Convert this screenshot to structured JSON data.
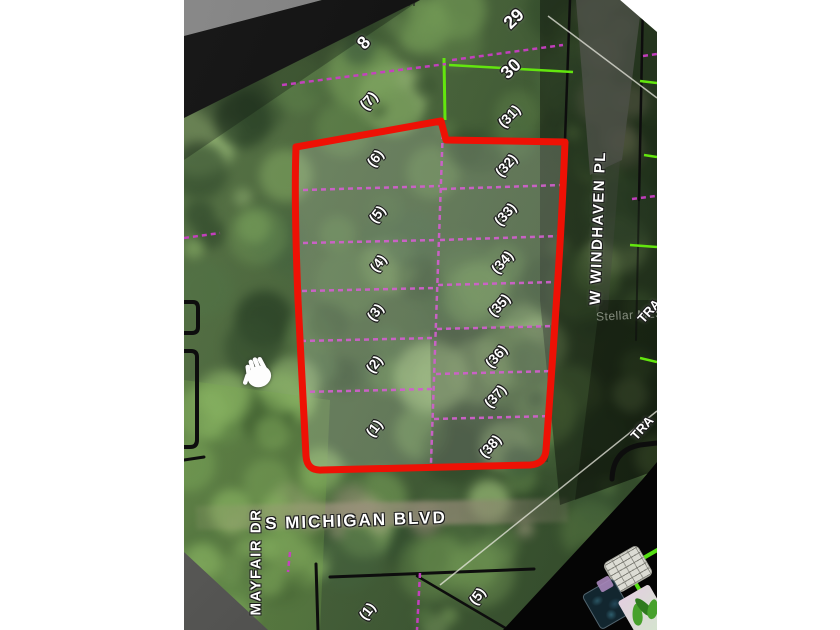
{
  "photo": {
    "watermark": "Stellar MLS",
    "streets": {
      "michigan": "S MICHIGAN BLVD",
      "mayfair": "MAYFAIR DR",
      "windhaven": "W WINDHAVEN PL",
      "tract_a": "TRA",
      "tract_b": "TRA"
    },
    "lot_labels": [
      {
        "text": "8",
        "x": 364,
        "y": 43,
        "rot": -48,
        "size": 18
      },
      {
        "text": "(7)",
        "x": 369,
        "y": 101,
        "rot": -48,
        "size": 15
      },
      {
        "text": "29",
        "x": 514,
        "y": 19,
        "rot": -44,
        "size": 18
      },
      {
        "text": "30",
        "x": 511,
        "y": 69,
        "rot": -44,
        "size": 18
      },
      {
        "text": "(31)",
        "x": 509,
        "y": 116,
        "rot": -46,
        "size": 14
      },
      {
        "text": "(6)",
        "x": 375,
        "y": 158,
        "rot": -52,
        "size": 14
      },
      {
        "text": "(5)",
        "x": 377,
        "y": 214,
        "rot": -52,
        "size": 14
      },
      {
        "text": "(4)",
        "x": 378,
        "y": 263,
        "rot": -52,
        "size": 14
      },
      {
        "text": "(3)",
        "x": 375,
        "y": 312,
        "rot": -52,
        "size": 14
      },
      {
        "text": "(2)",
        "x": 374,
        "y": 364,
        "rot": -52,
        "size": 14
      },
      {
        "text": "(1)",
        "x": 374,
        "y": 428,
        "rot": -52,
        "size": 14
      },
      {
        "text": "(32)",
        "x": 506,
        "y": 165,
        "rot": -48,
        "size": 14
      },
      {
        "text": "(33)",
        "x": 505,
        "y": 214,
        "rot": -48,
        "size": 14
      },
      {
        "text": "(34)",
        "x": 502,
        "y": 262,
        "rot": -48,
        "size": 14
      },
      {
        "text": "(35)",
        "x": 499,
        "y": 305,
        "rot": -48,
        "size": 14
      },
      {
        "text": "(36)",
        "x": 496,
        "y": 356,
        "rot": -48,
        "size": 14
      },
      {
        "text": "(37)",
        "x": 495,
        "y": 396,
        "rot": -48,
        "size": 14
      },
      {
        "text": "(38)",
        "x": 490,
        "y": 446,
        "rot": -48,
        "size": 14
      },
      {
        "text": "(1)",
        "x": 367,
        "y": 611,
        "rot": -52,
        "size": 14
      },
      {
        "text": "(5)",
        "x": 477,
        "y": 596,
        "rot": -52,
        "size": 14
      }
    ],
    "colors": {
      "parcel_outline": "#ee1105",
      "plat_magenta": "#c93ec4",
      "plat_green": "#63e60e",
      "plat_black": "#0d0d0d"
    }
  }
}
